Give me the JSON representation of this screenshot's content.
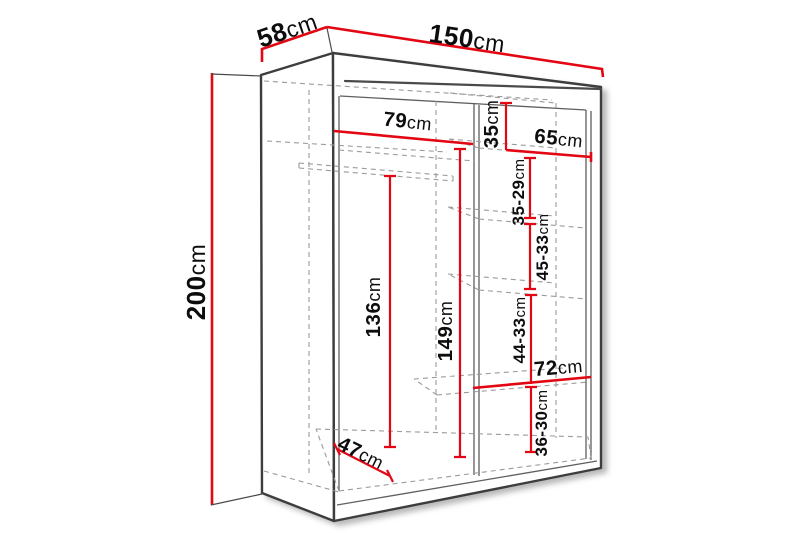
{
  "figure": {
    "type": "furniture-dimension-diagram",
    "subject": "sliding-door wardrobe, perspective line drawing with interior shelves and hanging rail"
  },
  "unit": "cm",
  "dimensions": {
    "depth": {
      "value": "58",
      "unit": "cm"
    },
    "width": {
      "value": "150",
      "unit": "cm"
    },
    "height": {
      "value": "200",
      "unit": "cm"
    },
    "left_section_width": {
      "value": "79",
      "unit": "cm"
    },
    "top_shelf_height": {
      "value": "35",
      "unit": "cm"
    },
    "right_section_width": {
      "value": "65",
      "unit": "cm"
    },
    "shelf_gap_1": {
      "value": "35-29",
      "unit": "cm"
    },
    "shelf_gap_2": {
      "value": "45-33",
      "unit": "cm"
    },
    "hanging_space_height": {
      "value": "136",
      "unit": "cm"
    },
    "left_interior_height": {
      "value": "149",
      "unit": "cm"
    },
    "shelf_gap_3": {
      "value": "44-33",
      "unit": "cm"
    },
    "wide_shelf_width": {
      "value": "72",
      "unit": "cm"
    },
    "shelf_gap_4": {
      "value": "36-30",
      "unit": "cm"
    },
    "interior_depth": {
      "value": "47",
      "unit": "cm"
    }
  },
  "colors": {
    "dimension_line": "#e30613",
    "outline": "#3d3d3d",
    "hidden_line": "#9b9b9b",
    "background": "#ffffff",
    "label_text": "#0d0d0d"
  }
}
